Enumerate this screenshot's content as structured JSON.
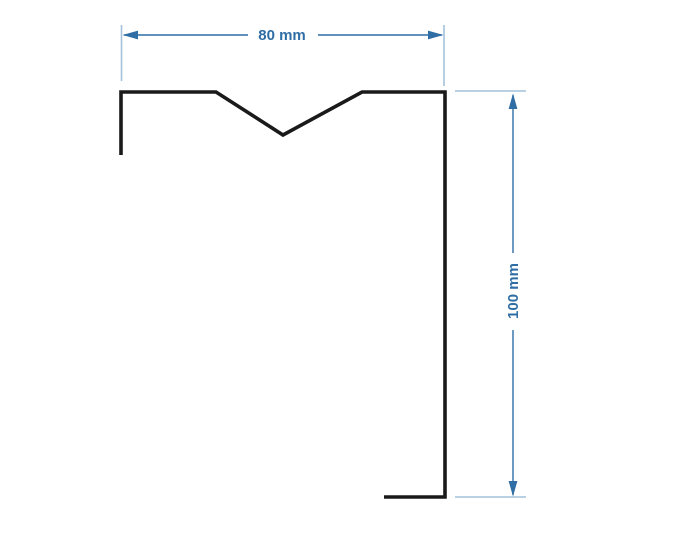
{
  "drawing": {
    "kind": "profile-cross-section",
    "units": "mm",
    "background_color": "#ffffff",
    "profile": {
      "description": "sheet-metal profile with v-notch top flange, right web and bottom foot",
      "stroke_color": "#1a1a1a",
      "points": "121,155 121,92 216,92 283,135 362,92 445,92 445,497 384,497"
    },
    "dimensions": {
      "width": {
        "label": "80 mm",
        "value": 80,
        "unit": "mm",
        "orientation": "horizontal"
      },
      "height": {
        "label": "100 mm",
        "value": 100,
        "unit": "mm",
        "orientation": "vertical"
      }
    },
    "colors": {
      "dimension_line": "#2f6ea5",
      "extension_line": "#a3c1da",
      "arrowhead": "#2f6ea5",
      "label_text": "#2f6ea5",
      "profile_line": "#1a1a1a"
    }
  }
}
